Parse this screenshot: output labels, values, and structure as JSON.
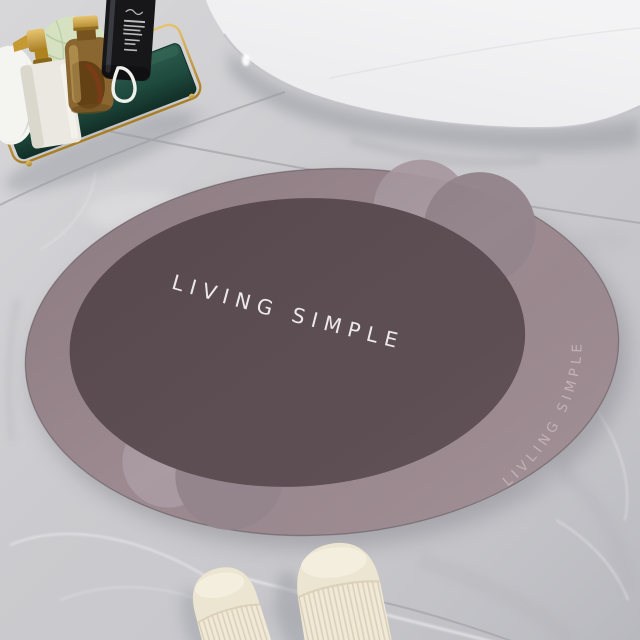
{
  "scene": {
    "type": "bathroom-product-photo",
    "mat": {
      "main_text": "LIVING SIMPLE",
      "rim_text": "LIVLING SIMPLE"
    },
    "objects": {
      "bathtub": "white freestanding bathtub",
      "tray": "emerald tray with gold wire rail",
      "towel": "white towel",
      "soap_dispenser": "white pump dispenser with gold pump",
      "herbal_bottle": "amber herbal bottle with gold cap",
      "black_bottle": "black pump bottle with white label",
      "loofah": "pale green loofah sponge",
      "cord": "white hanging cord loop",
      "slippers": "cream spa slippers",
      "floor": "gray marble tile floor"
    }
  },
  "colors": {
    "floor": "#c8c8cc",
    "grout": "#a4a4aa",
    "tub": "#ededef",
    "mat_band": "#9c8a90",
    "mat_band_light": "#a99ba1",
    "mat_band_mid": "#95858d",
    "mat_inner": "#5d4e53",
    "mat_main_text": "#f3eff0",
    "mat_rim_text": "#c9b6bc",
    "mat_shadow": "#8c8c93",
    "tray_green": "#20493d",
    "gold": "#c9a24c",
    "towel": "#f4f4f1",
    "dispenser": "#ebe8e1",
    "amber": "#8a6630",
    "black_bottle": "#17171a",
    "label": "#d8d8da",
    "loofah": "#d5e1c1",
    "cord": "#f0f0ec",
    "slipper": "#ece5d2",
    "slipper_rib": "#d9cfb6",
    "shadow": "#9a9ba1"
  }
}
